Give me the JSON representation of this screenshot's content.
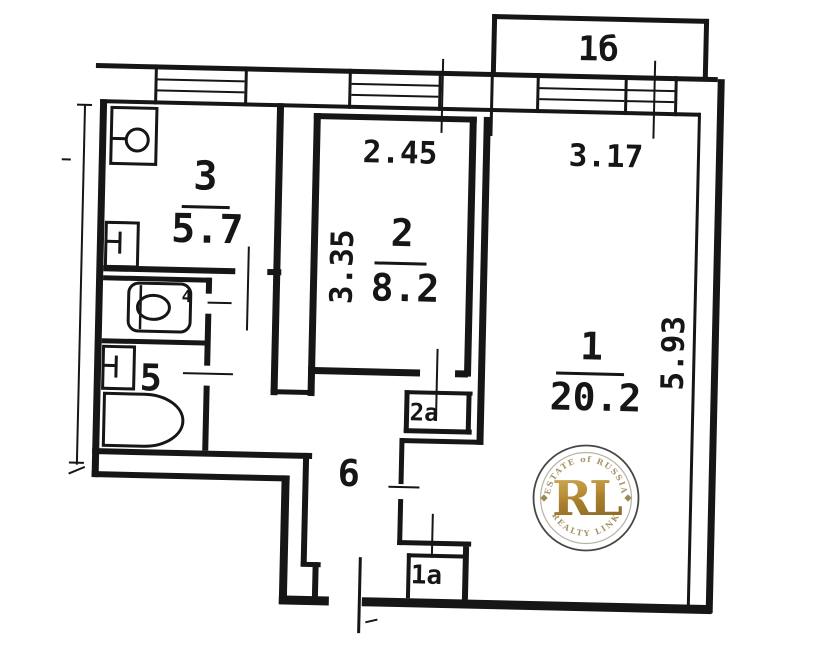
{
  "plan": {
    "rooms": {
      "r1": {
        "number": "1",
        "area": "20.2"
      },
      "r2": {
        "number": "2",
        "area": "8.2"
      },
      "r3": {
        "number": "3",
        "area": "5.7"
      },
      "r4": {
        "number": "4"
      },
      "r5": {
        "number": "5"
      },
      "r6": {
        "number": "6"
      },
      "balcony": {
        "number": "1б"
      },
      "closet2a": {
        "number": "2а"
      },
      "closet1a": {
        "number": "1а"
      }
    },
    "dimensions": {
      "room2_width": "2.45",
      "room1_width": "3.17",
      "room2_depth": "3.35",
      "room1_depth": "5.93"
    },
    "ink_color": "#161616"
  },
  "watermark": {
    "arc_top": "ESTATE of RUSSIA",
    "monogram": "RL",
    "arc_bottom": "REALTY LINK",
    "gold_color": "#b8923d",
    "ring_text_color": "#a59465"
  }
}
